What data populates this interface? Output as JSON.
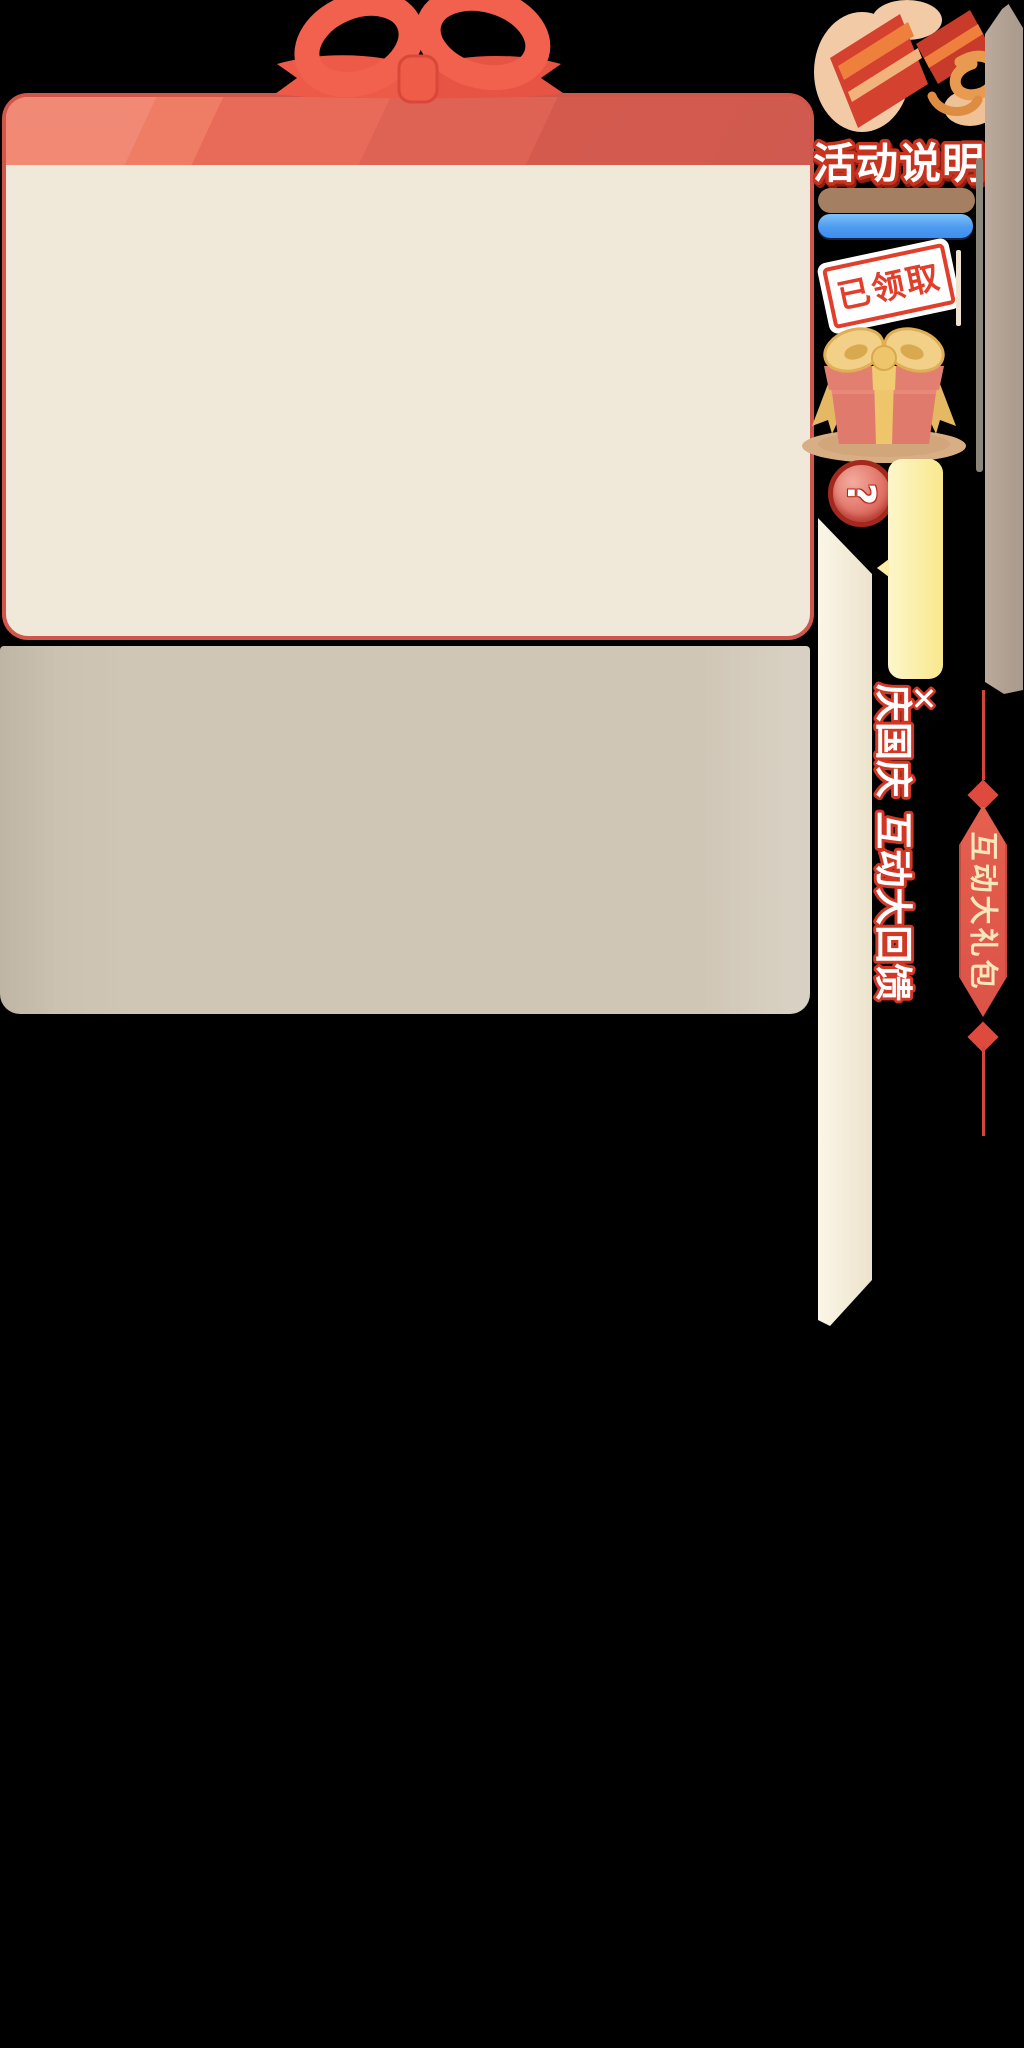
{
  "window": {
    "width": 1024,
    "height": 2048,
    "background": "#000000"
  },
  "panels": {
    "main": {
      "header_color": "#e96a58",
      "body_color": "#f0e8d9",
      "border_color": "#d0564c"
    },
    "lower": {
      "color": "#cfc6b6"
    }
  },
  "right_rail": {
    "activity": {
      "title": "活动说明",
      "title_fill": "#ffffff",
      "title_outline": "#c7331f",
      "icon": "open-gift-icon"
    },
    "bars": {
      "brown": "#a47f62",
      "blue_top": "#79bef8",
      "blue_bottom": "#3e8eef"
    },
    "stamp": {
      "label": "已领取",
      "color": "#e23e2c"
    },
    "gift": {
      "icon": "gift-box-icon",
      "box_color": "#e07a6d",
      "ribbon_color": "#eec56a"
    },
    "help": {
      "label": "?"
    },
    "tooltip": {
      "color": "#f9e88c"
    },
    "event": {
      "title": "庆国庆 互动大回馈",
      "close": "✕",
      "outline": "#d23726"
    },
    "rail": {
      "bar_color": "#b2a294",
      "scrollbar_color": "#8b8677"
    },
    "banner": {
      "label": "互动大礼包",
      "color": "#e05a4e",
      "text_color": "#f6e6ba"
    }
  }
}
